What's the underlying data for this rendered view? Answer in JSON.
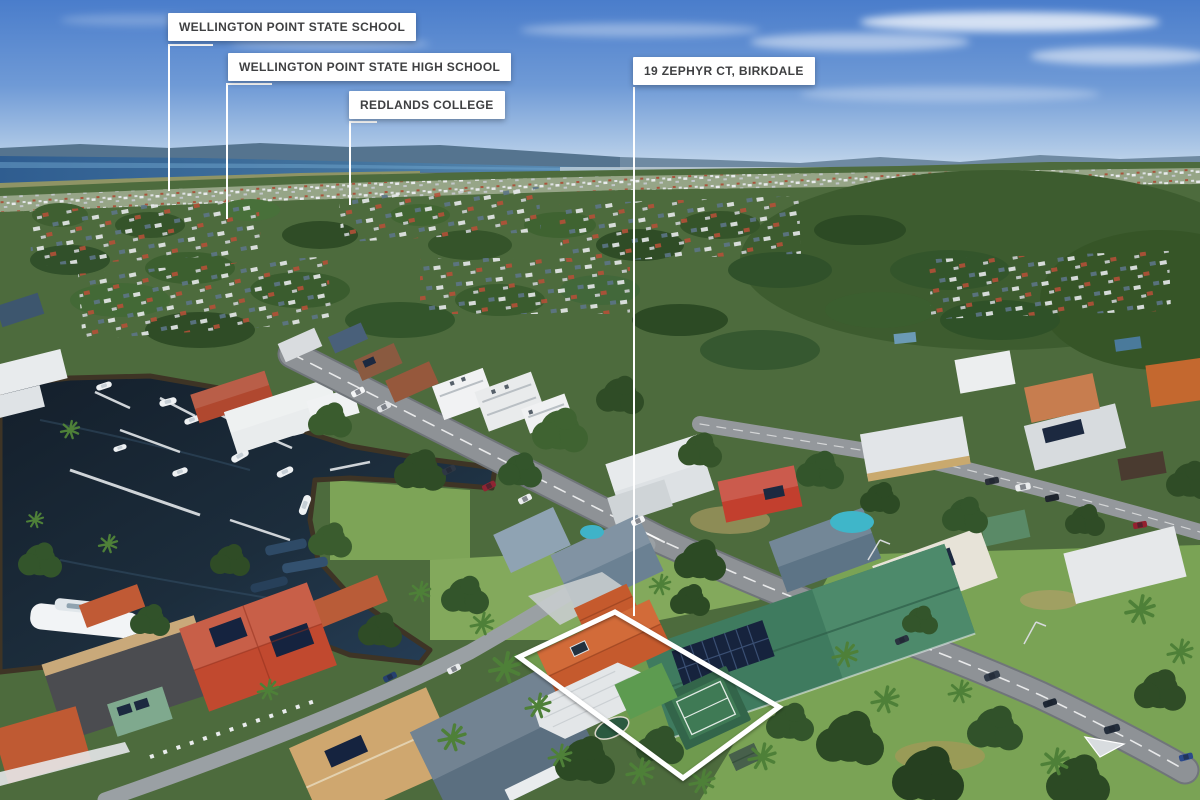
{
  "labels": {
    "school_primary": "WELLINGTON POINT STATE SCHOOL",
    "school_high": "WELLINGTON POINT STATE HIGH SCHOOL",
    "college": "REDLANDS COLLEGE",
    "property": "19 ZEPHYR CT, BIRKDALE"
  },
  "colors": {
    "label_bg": "#ffffff",
    "label_text": "#3f4042",
    "outline": "#ffffff",
    "sky_top": "#4a7dcb",
    "sky_horizon": "#dde9f3",
    "hills": "#55748f",
    "bay_water": "#3f6f9f",
    "canal_water": "#1b2a38",
    "canopy_green": "#46663a",
    "road_gray": "#8e9296",
    "subject_roof_orange": "#c55a2d",
    "neighbor_roof_green": "#3f7b5f",
    "court_green": "#3f7a55"
  }
}
